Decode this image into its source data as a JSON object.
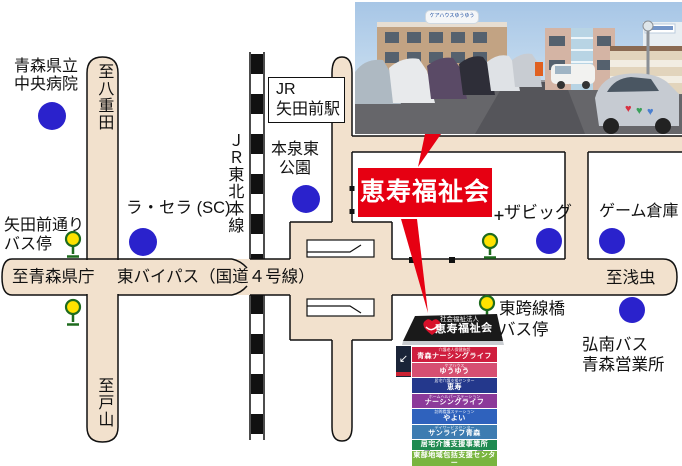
{
  "colors": {
    "accent_red": "#e60012",
    "road_beige": "#f2e1cd",
    "landmark_blue": "#2a22cc",
    "signal_yellow": "#ffe200",
    "signal_green": "#1e6b1e"
  },
  "map": {
    "facility_label": "恵寿福祉会",
    "hospital_lines": [
      "青森県立",
      "中央病院"
    ],
    "to_yaeda": "至八重田",
    "to_toyama": "至戸山",
    "to_kencho": "至青森県庁",
    "to_asamushi": "至浅虫",
    "bypass_label": "東バイパス（国道４号線）",
    "jr_line_label": "ＪＲ東北本線",
    "station_lines": [
      "JR",
      "矢田前駅"
    ],
    "park_lines": [
      "本泉東",
      "公園"
    ],
    "la_sera": "ラ・セラ (SC)",
    "yadamae_bus_lines": [
      "矢田前通り",
      "バス停"
    ],
    "the_big": "ザビッグ",
    "game_warehouse": "ゲーム倉庫",
    "kosenkyo_bus_lines": [
      "東跨線橋",
      "バス停"
    ],
    "konan_lines": [
      "弘南バス",
      "青森営業所"
    ]
  },
  "photo": {
    "rooftop_sign": "ケアハウスゆうゆう"
  },
  "signboard": {
    "header_sub": "社会福祉法人",
    "header_main": "恵寿福祉会",
    "entrance_arrow": "↙",
    "panels": [
      {
        "sub": "介護老人保健施設",
        "label": "青森ナーシングライフ",
        "bg": "#cf1e3e"
      },
      {
        "sub": "ケアハウス",
        "label": "ゆうゆう",
        "bg": "#d64f72"
      },
      {
        "sub": "居宅介護支援センター",
        "label": "恵寿",
        "bg": "#24388c"
      },
      {
        "sub": "ホームヘルパーステーション",
        "label": "ナーシングライフ",
        "bg": "#8c3a9a"
      },
      {
        "sub": "訪問看護ステーション",
        "label": "やよい",
        "bg": "#2f62bd"
      },
      {
        "sub": "デイサービスセンター",
        "label": "サンライフ青森",
        "bg": "#3d7cb1"
      },
      {
        "sub": "",
        "label": "居宅介護支援事業所",
        "bg": "#1e8a50"
      },
      {
        "sub": "",
        "label": "東部地域包括支援センター",
        "bg": "#79b53f"
      }
    ]
  }
}
